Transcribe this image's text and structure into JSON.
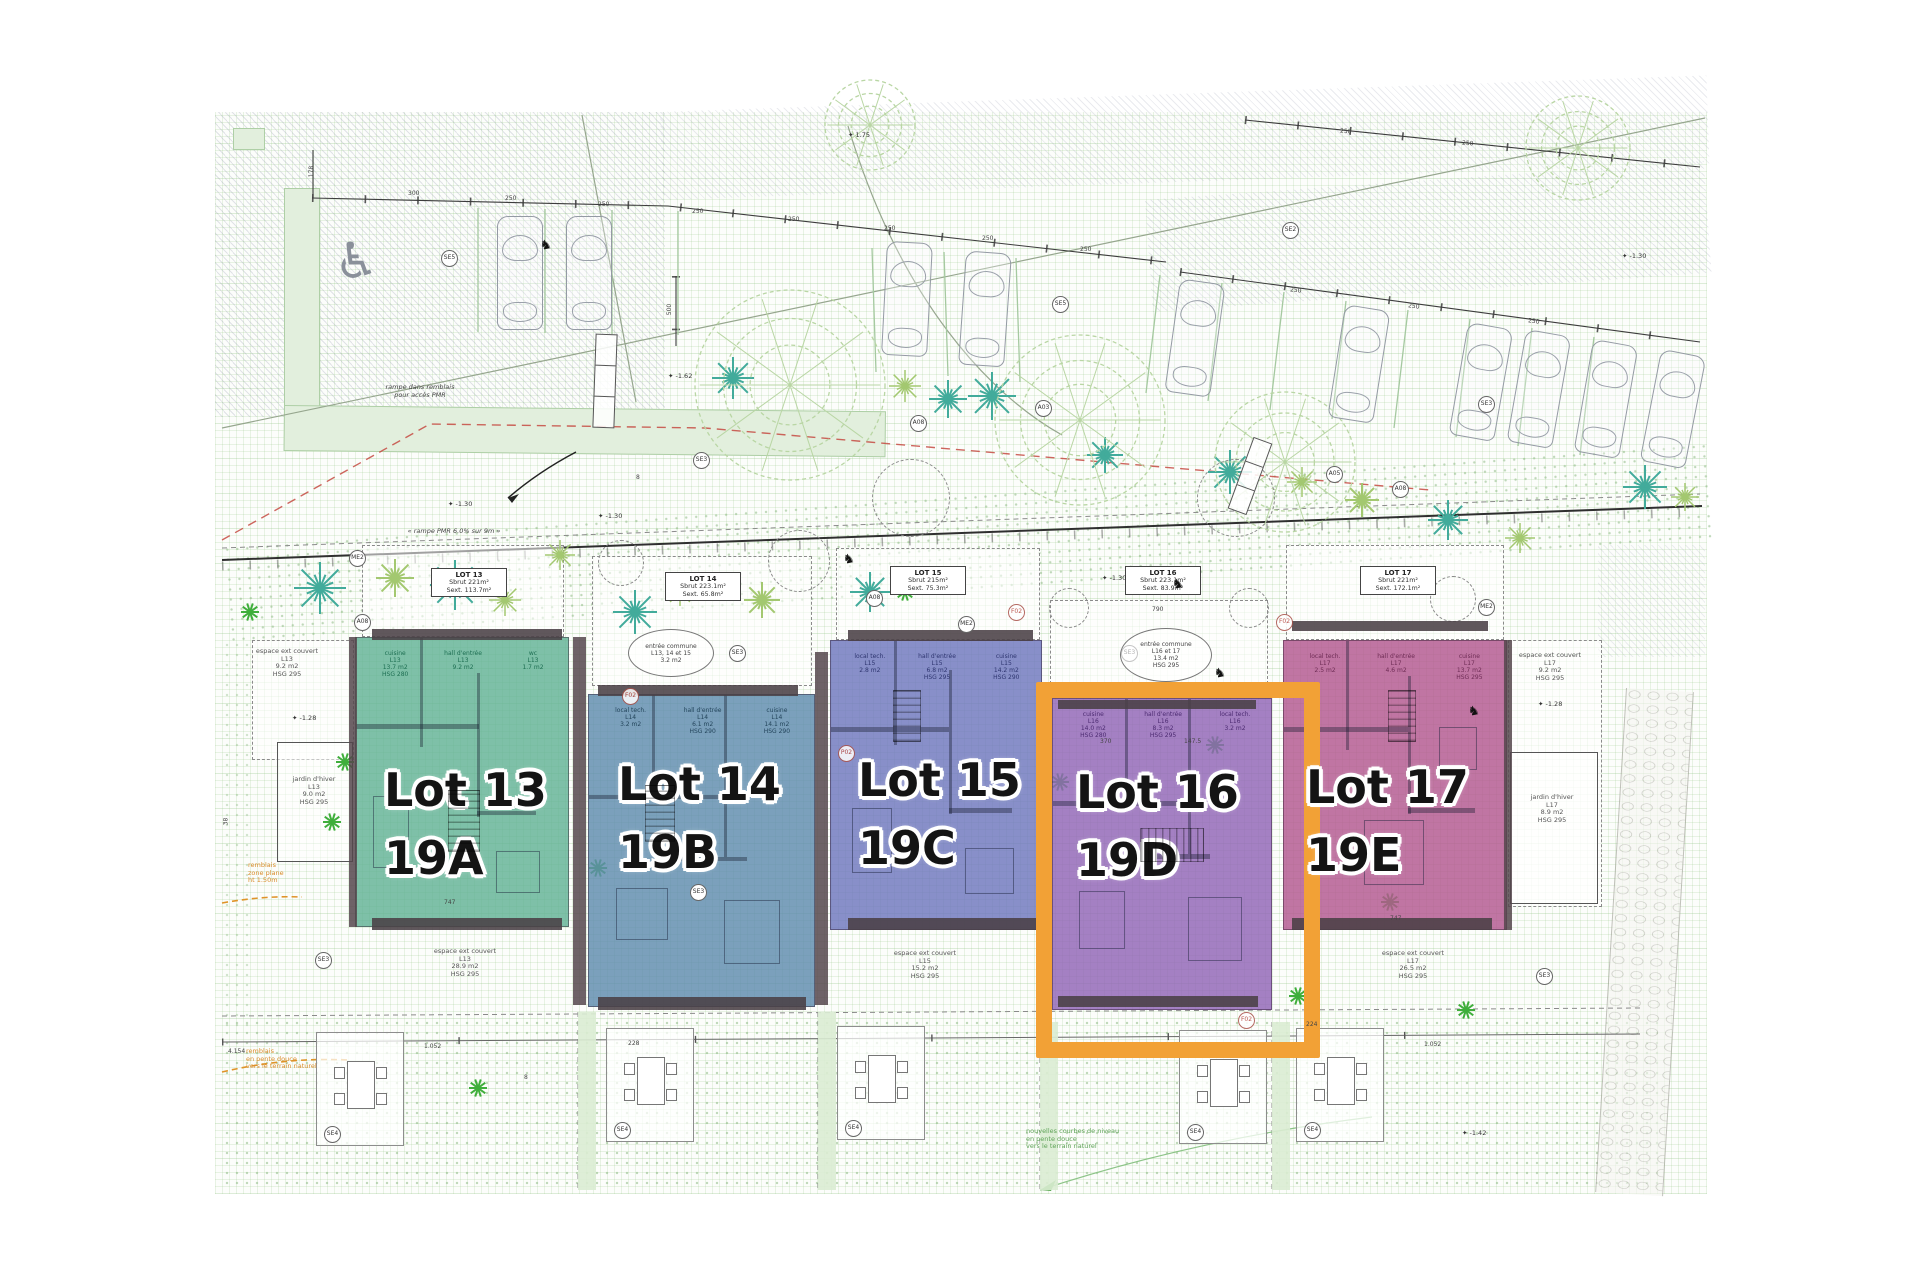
{
  "plan": {
    "type": "site-plan",
    "language": "fr"
  },
  "lots": [
    {
      "label": "Lot 13",
      "unit": "19A",
      "color": "#62b295",
      "line": "#1d6e52",
      "info": {
        "name": "LOT 13",
        "sbrut": "Sbrut 221m²",
        "sext": "Sext. 113.7m²"
      },
      "rooms": [
        "cuisine\nL13\n13.7 m2\nHSG 280",
        "hall d'entrée\nL13\n9.2 m2",
        "wc\nL13\n1.7 m2"
      ]
    },
    {
      "label": "Lot 14",
      "unit": "19B",
      "color": "#5f8cae",
      "line": "#24455c",
      "info": {
        "name": "LOT 14",
        "sbrut": "Sbrut 223.1m²",
        "sext": "Sext. 65.8m²"
      },
      "rooms": [
        "local tech.\nL14\n3.2 m2",
        "hall d'entrée\nL14\n6.1 m2\nHSG 290",
        "cuisine\nL14\n14.1 m2\nHSG 290"
      ]
    },
    {
      "label": "Lot 15",
      "unit": "19C",
      "color": "#6f77bd",
      "line": "#2e3570",
      "info": {
        "name": "LOT 15",
        "sbrut": "Sbrut 215m²",
        "sext": "Sext. 75.3m²"
      },
      "rooms": [
        "local tech.\nL15\n2.8 m2",
        "hall d'entrée\nL15\n6.8 m2\nHSG 295",
        "cuisine\nL15\n14.2 m2\nHSG 290"
      ]
    },
    {
      "label": "Lot 16",
      "unit": "19D",
      "color": "#9065b6",
      "line": "#4b2a70",
      "highlighted": true,
      "highlight_color": "#f2a136",
      "info": {
        "name": "LOT 16",
        "sbrut": "Sbrut 223.1m²",
        "sext": "Sext. 83.9m²"
      },
      "rooms": [
        "cuisine\nL16\n14.0 m2\nHSG 280",
        "hall d'entrée\nL16\n8.3 m2\nHSG 295",
        "local tech.\nL16\n3.2 m2"
      ]
    },
    {
      "label": "Lot 17",
      "unit": "19E",
      "color": "#b2578f",
      "line": "#6e2c55",
      "info": {
        "name": "LOT 17",
        "sbrut": "Sbrut 221m²",
        "sext": "Sext. 172.1m²"
      },
      "rooms": [
        "local tech.\nL17\n2.5 m2",
        "hall d'entrée\nL17\n4.6 m2",
        "cuisine\nL17\n13.7 m2\nHSG 295"
      ]
    }
  ],
  "ellipses": [
    {
      "t": "entrée commune\nL13, 14 et 15\n3.2 m2",
      "x": 628,
      "y": 629,
      "w": 84,
      "h": 46
    },
    {
      "t": "entrée commune\nL16 et 17\n13.4 m2\nHSG 295",
      "x": 1120,
      "y": 628,
      "w": 90,
      "h": 52
    }
  ],
  "decor": {
    "texts": [
      {
        "t": "rampe dans remblais\npour accès PMR",
        "x": 372,
        "y": 384,
        "w": 96,
        "c": "italic"
      },
      {
        "t": "« rampe PMR 6.0% sur 9m »",
        "x": 398,
        "y": 528,
        "w": 112,
        "c": "italic"
      },
      {
        "t": "espace ext couvert\nL13\n9.2 m2\nHSG 295",
        "x": 248,
        "y": 648,
        "w": 78
      },
      {
        "t": "jardin d'hiver\nL13\n9.0 m2\nHSG 295",
        "x": 282,
        "y": 776,
        "w": 64
      },
      {
        "t": "remblais\nzone plane\nht 1.50m",
        "x": 248,
        "y": 862,
        "w": 60,
        "c": "orange"
      },
      {
        "t": "remblais\nen pente douce\nvers le terrain naturel",
        "x": 246,
        "y": 1048,
        "w": 92,
        "c": "orange"
      },
      {
        "t": "espace ext couvert\nL13\n28.9 m2\nHSG 295",
        "x": 420,
        "y": 948,
        "w": 90
      },
      {
        "t": "espace ext couvert\nL15\n15.2 m2\nHSG 295",
        "x": 880,
        "y": 950,
        "w": 90
      },
      {
        "t": "espace ext couvert\nL17\n26.5 m2\nHSG 295",
        "x": 1368,
        "y": 950,
        "w": 90
      },
      {
        "t": "espace ext couvert\nL17\n9.2 m2\nHSG 295",
        "x": 1510,
        "y": 652,
        "w": 80
      },
      {
        "t": "jardin d'hiver\nL17\n8.9 m2\nHSG 295",
        "x": 1516,
        "y": 794,
        "w": 72
      },
      {
        "t": "nouvelles courbes de niveau\nen pente douce\nvers le terrain naturel",
        "x": 1026,
        "y": 1128,
        "w": 122,
        "c": "green"
      }
    ],
    "markers": [
      {
        "t": "SE5",
        "x": 441,
        "y": 250
      },
      {
        "t": "SE5",
        "x": 1052,
        "y": 296
      },
      {
        "t": "SE3",
        "x": 693,
        "y": 452
      },
      {
        "t": "SE2",
        "x": 1282,
        "y": 222
      },
      {
        "t": "SE3",
        "x": 1478,
        "y": 396
      },
      {
        "t": "A05",
        "x": 1326,
        "y": 466
      },
      {
        "t": "A08",
        "x": 1392,
        "y": 481
      },
      {
        "t": "A08",
        "x": 910,
        "y": 415
      },
      {
        "t": "A03",
        "x": 1035,
        "y": 400
      },
      {
        "t": "A08",
        "x": 354,
        "y": 614
      },
      {
        "t": "A08",
        "x": 866,
        "y": 590
      },
      {
        "t": "ME2",
        "x": 349,
        "y": 550
      },
      {
        "t": "ME2",
        "x": 958,
        "y": 616
      },
      {
        "t": "ME2",
        "x": 1478,
        "y": 599
      },
      {
        "t": "SE3",
        "x": 729,
        "y": 645
      },
      {
        "t": "SE3",
        "x": 1121,
        "y": 645
      },
      {
        "t": "SE3",
        "x": 315,
        "y": 952
      },
      {
        "t": "SE3",
        "x": 690,
        "y": 884
      },
      {
        "t": "SE3",
        "x": 1536,
        "y": 968
      },
      {
        "t": "SE4",
        "x": 324,
        "y": 1126
      },
      {
        "t": "SE4",
        "x": 614,
        "y": 1122
      },
      {
        "t": "SE4",
        "x": 845,
        "y": 1120
      },
      {
        "t": "SE4",
        "x": 1187,
        "y": 1124
      },
      {
        "t": "SE4",
        "x": 1304,
        "y": 1122
      },
      {
        "t": "F02",
        "x": 622,
        "y": 688,
        "r": 1
      },
      {
        "t": "F02",
        "x": 1008,
        "y": 604,
        "r": 1
      },
      {
        "t": "F02",
        "x": 1276,
        "y": 614,
        "r": 1
      },
      {
        "t": "P02",
        "x": 838,
        "y": 745,
        "r": 1
      },
      {
        "t": "F02",
        "x": 1238,
        "y": 1012,
        "r": 1
      }
    ],
    "levels": [
      {
        "t": "-1.30",
        "x": 448,
        "y": 500
      },
      {
        "t": "-1.30",
        "x": 598,
        "y": 512
      },
      {
        "t": "-1.30",
        "x": 1102,
        "y": 574
      },
      {
        "t": "-1.30",
        "x": 1622,
        "y": 252
      },
      {
        "t": "-1.28",
        "x": 292,
        "y": 714
      },
      {
        "t": "-1.28",
        "x": 1538,
        "y": 700
      },
      {
        "t": "-1.62",
        "x": 668,
        "y": 372
      },
      {
        "t": "1.75",
        "x": 848,
        "y": 131
      },
      {
        "t": "-1.42",
        "x": 1462,
        "y": 1129
      }
    ],
    "dimlabels": [
      {
        "t": "300",
        "x": 408,
        "y": 190
      },
      {
        "t": "250",
        "x": 505,
        "y": 195
      },
      {
        "t": "250",
        "x": 598,
        "y": 201
      },
      {
        "t": "250",
        "x": 692,
        "y": 208
      },
      {
        "t": "250",
        "x": 788,
        "y": 216
      },
      {
        "t": "250",
        "x": 884,
        "y": 225
      },
      {
        "t": "250",
        "x": 982,
        "y": 235
      },
      {
        "t": "250",
        "x": 1080,
        "y": 246
      },
      {
        "t": "178",
        "x": 306,
        "y": 168,
        "r": -90
      },
      {
        "t": "500",
        "x": 664,
        "y": 306,
        "r": -90
      },
      {
        "t": "250",
        "x": 1290,
        "y": 287,
        "r": 6
      },
      {
        "t": "250",
        "x": 1408,
        "y": 303,
        "r": 7
      },
      {
        "t": "250",
        "x": 1528,
        "y": 318,
        "r": 7
      },
      {
        "t": "250",
        "x": 1340,
        "y": 128,
        "r": 4
      },
      {
        "t": "250",
        "x": 1462,
        "y": 140,
        "r": 4
      },
      {
        "t": "790",
        "x": 1152,
        "y": 606
      },
      {
        "t": "747",
        "x": 444,
        "y": 899
      },
      {
        "t": "747",
        "x": 1390,
        "y": 915
      },
      {
        "t": "370",
        "x": 1100,
        "y": 738
      },
      {
        "t": "147.5",
        "x": 1184,
        "y": 738
      },
      {
        "t": "224",
        "x": 1306,
        "y": 1021
      },
      {
        "t": "1.052",
        "x": 424,
        "y": 1043
      },
      {
        "t": "1.052",
        "x": 1424,
        "y": 1041
      },
      {
        "t": "4.154",
        "x": 228,
        "y": 1048
      },
      {
        "t": "228",
        "x": 628,
        "y": 1040
      },
      {
        "t": "38",
        "x": 222,
        "y": 818,
        "r": -90
      },
      {
        "t": "8",
        "x": 636,
        "y": 474
      },
      {
        "t": "8",
        "x": 524,
        "y": 1074
      }
    ],
    "cars": [
      [
        497,
        216,
        0
      ],
      [
        566,
        216,
        0
      ],
      [
        884,
        242,
        3
      ],
      [
        962,
        252,
        4
      ],
      [
        1172,
        281,
        8
      ],
      [
        1336,
        307,
        9
      ],
      [
        1458,
        325,
        10
      ],
      [
        1516,
        332,
        10
      ],
      [
        1583,
        342,
        10
      ],
      [
        1650,
        352,
        11
      ]
    ],
    "star_trees": [
      [
        320,
        588,
        26,
        0
      ],
      [
        395,
        578,
        19,
        1
      ],
      [
        455,
        585,
        25,
        0
      ],
      [
        505,
        600,
        16,
        1
      ],
      [
        560,
        555,
        15,
        1
      ],
      [
        635,
        612,
        22,
        0
      ],
      [
        680,
        592,
        14,
        1
      ],
      [
        733,
        378,
        21,
        0
      ],
      [
        762,
        600,
        18,
        1
      ],
      [
        870,
        592,
        20,
        0
      ],
      [
        905,
        386,
        16,
        1
      ],
      [
        948,
        399,
        19,
        0
      ],
      [
        992,
        396,
        24,
        0
      ],
      [
        1105,
        455,
        18,
        0
      ],
      [
        1230,
        472,
        22,
        0
      ],
      [
        1302,
        482,
        15,
        1
      ],
      [
        1362,
        500,
        17,
        1
      ],
      [
        1448,
        520,
        20,
        0
      ],
      [
        1520,
        538,
        15,
        1
      ],
      [
        1645,
        487,
        22,
        0
      ],
      [
        1685,
        497,
        14,
        1
      ]
    ],
    "leafy_trees": [
      [
        790,
        385,
        95
      ],
      [
        1080,
        420,
        85
      ],
      [
        1285,
        462,
        70
      ],
      [
        1578,
        148,
        52
      ],
      [
        870,
        125,
        45
      ]
    ],
    "dashed_circles": [
      [
        620,
        562,
        22
      ],
      [
        798,
        560,
        30
      ],
      [
        910,
        497,
        38
      ],
      [
        1235,
        497,
        38
      ],
      [
        1068,
        607,
        19
      ],
      [
        1248,
        607,
        19
      ],
      [
        1452,
        598,
        22
      ]
    ],
    "plants": [
      [
        250,
        612
      ],
      [
        345,
        762
      ],
      [
        332,
        822
      ],
      [
        905,
        592
      ],
      [
        770,
        772
      ],
      [
        1060,
        782
      ],
      [
        1298,
        996
      ],
      [
        1390,
        902
      ],
      [
        478,
        1088
      ],
      [
        1466,
        1010
      ],
      [
        1215,
        745
      ],
      [
        598,
        868
      ]
    ],
    "scooters": [
      [
        540,
        238
      ],
      [
        1172,
        577
      ],
      [
        1214,
        666
      ],
      [
        1468,
        704
      ],
      [
        843,
        552
      ]
    ],
    "steps": [
      [
        594,
        334,
        20,
        92,
        2
      ],
      [
        1240,
        438,
        18,
        74,
        20
      ]
    ],
    "stairs": [
      [
        448,
        790,
        30,
        60,
        0
      ],
      [
        645,
        785,
        28,
        55,
        0
      ],
      [
        893,
        690,
        26,
        50,
        0
      ],
      [
        1140,
        828,
        62,
        32,
        1
      ],
      [
        1388,
        690,
        26,
        50,
        0
      ]
    ],
    "strips": [
      [
        578,
        1012,
        18,
        178
      ],
      [
        818,
        1012,
        18,
        178
      ],
      [
        1040,
        1022,
        18,
        168
      ],
      [
        1272,
        1022,
        18,
        168
      ]
    ],
    "terraces": [
      [
        316,
        1032
      ],
      [
        606,
        1028
      ],
      [
        837,
        1026
      ],
      [
        1179,
        1030
      ],
      [
        1296,
        1028
      ]
    ],
    "tree_colors": {
      "teal": "#42ab9b",
      "green": "#a3c870",
      "plant": "#3fae3b",
      "leafy": "#b9d6a4"
    }
  }
}
